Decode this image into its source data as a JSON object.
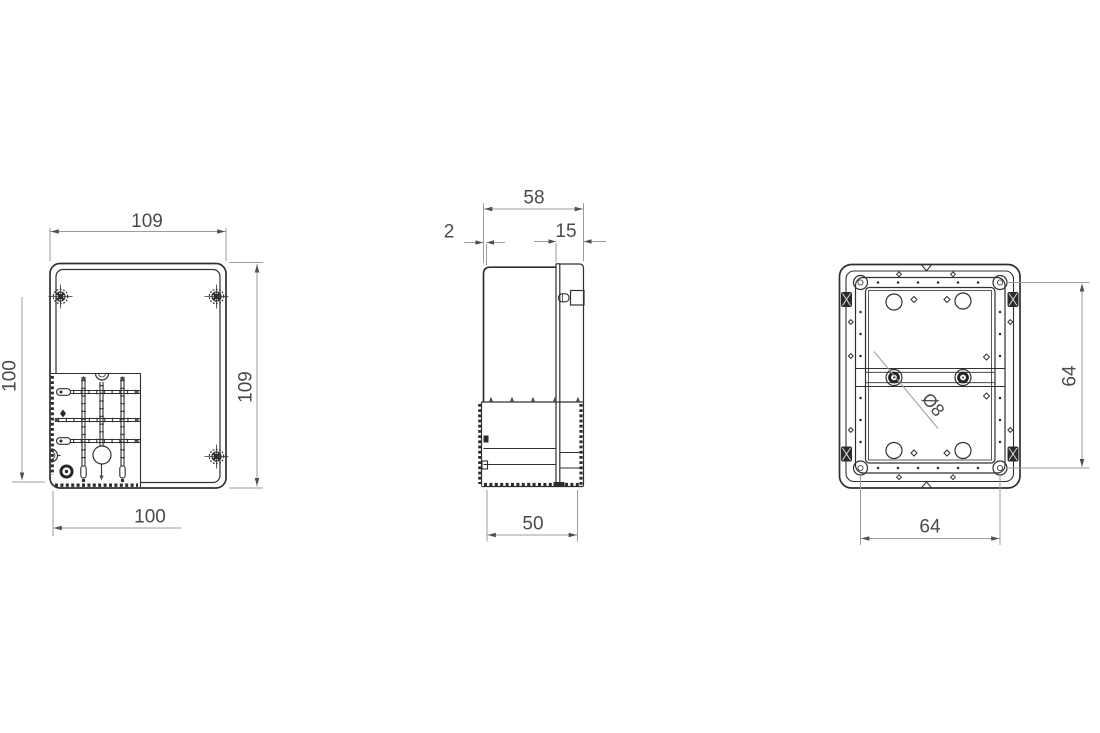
{
  "drawing": {
    "background": "#ffffff",
    "line_color": "#303030",
    "dim_line_color": "#9b9b9b",
    "dim_text_color": "#4a4a4a",
    "views": {
      "front": {
        "dim_width_top": "109",
        "dim_height_right": "109",
        "dim_height_left": "100",
        "dim_width_bottom": "100"
      },
      "side": {
        "dim_depth_total": "58",
        "dim_wall_thickness": "2",
        "dim_lid_depth": "15",
        "dim_body_depth": "50"
      },
      "back": {
        "dim_mount_spacing_vertical": "64",
        "dim_mount_spacing_horizontal": "64",
        "dim_hole_diameter": "Ø8"
      }
    }
  }
}
